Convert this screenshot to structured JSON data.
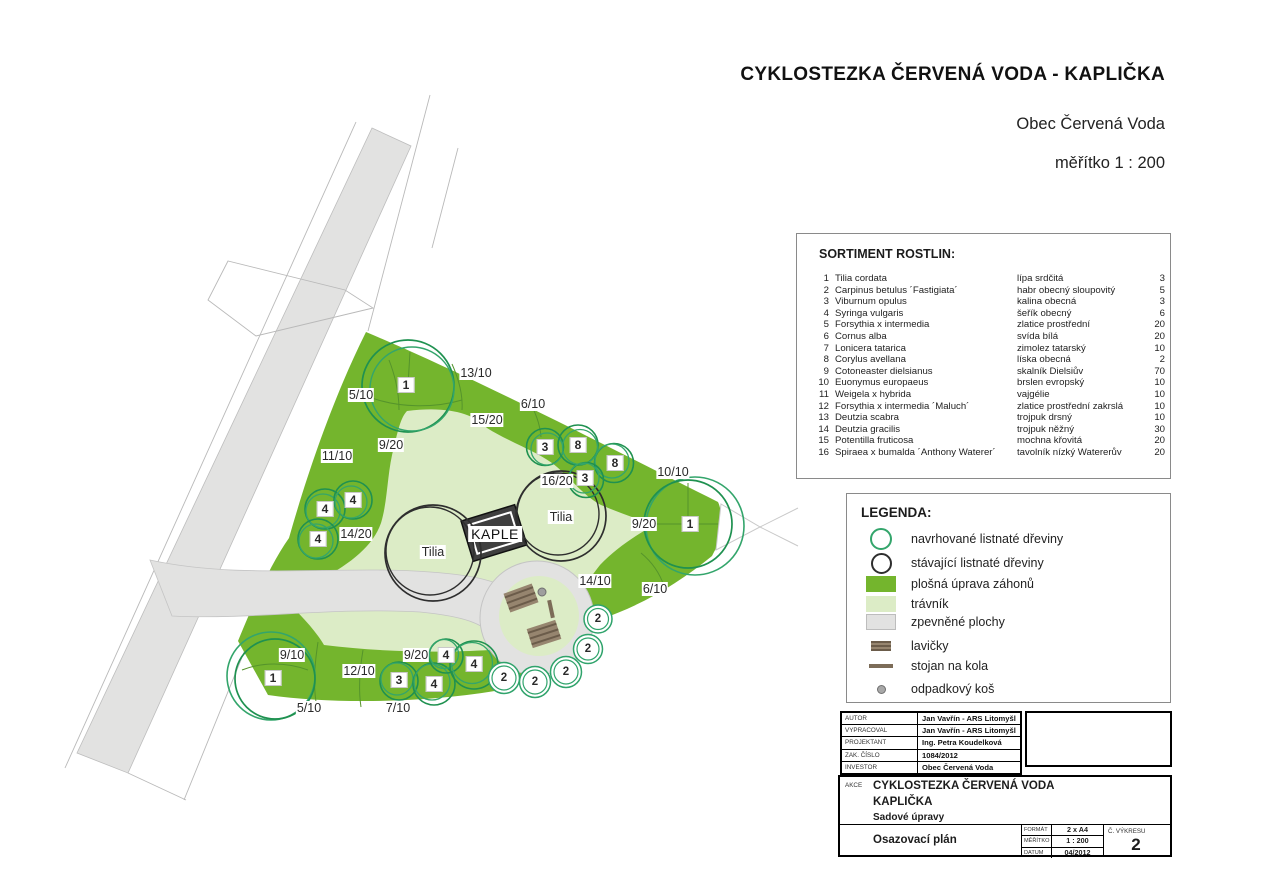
{
  "header": {
    "title": "CYKLOSTEZKA ČERVENÁ VODA - KAPLIČKA",
    "subtitle": "Obec Červená Voda",
    "scale_note": "měřítko 1 : 200"
  },
  "colors": {
    "bed_green": "#74b52d",
    "lawn_green": "#dcecc6",
    "paving_gray": "#e2e2e1",
    "proposed_tree_outline": "#33a56b",
    "existing_tree_outline": "#2e2e2e",
    "bench_brown": "#8b7b67"
  },
  "sortiment": {
    "title": "SORTIMENT ROSTLIN:",
    "rows": [
      {
        "num": "1",
        "latin": "Tilia cordata",
        "czech": "lípa srdčitá",
        "count": "3"
      },
      {
        "num": "2",
        "latin": "Carpinus betulus ´Fastigiata´",
        "czech": "habr obecný sloupovitý",
        "count": "5"
      },
      {
        "num": "3",
        "latin": "Viburnum opulus",
        "czech": "kalina obecná",
        "count": "3"
      },
      {
        "num": "4",
        "latin": "Syringa vulgaris",
        "czech": "šeřík obecný",
        "count": "6"
      },
      {
        "num": "5",
        "latin": "Forsythia x intermedia",
        "czech": "zlatice prostřední",
        "count": "20"
      },
      {
        "num": "6",
        "latin": "Cornus alba",
        "czech": "svída bílá",
        "count": "20"
      },
      {
        "num": "7",
        "latin": "Lonicera tatarica",
        "czech": "zimolez tatarský",
        "count": "10"
      },
      {
        "num": "8",
        "latin": "Corylus avellana",
        "czech": "líska obecná",
        "count": "2"
      },
      {
        "num": "9",
        "latin": "Cotoneaster dielsianus",
        "czech": "skalník Dielsiův",
        "count": "70"
      },
      {
        "num": "10",
        "latin": "Euonymus europaeus",
        "czech": "brslen evropský",
        "count": "10"
      },
      {
        "num": "11",
        "latin": "Weigela x hybrida",
        "czech": "vajgélie",
        "count": "10"
      },
      {
        "num": "12",
        "latin": "Forsythia x intermedia ´Maluch´",
        "czech": "zlatice prostřední zakrslá",
        "count": "10"
      },
      {
        "num": "13",
        "latin": "Deutzia scabra",
        "czech": "trojpuk drsný",
        "count": "10"
      },
      {
        "num": "14",
        "latin": "Deutzia gracilis",
        "czech": "trojpuk něžný",
        "count": "30"
      },
      {
        "num": "15",
        "latin": "Potentilla fruticosa",
        "czech": "mochna křovitá",
        "count": "20"
      },
      {
        "num": "16",
        "latin": "Spiraea x bumalda ´Anthony Waterer´",
        "czech": "tavolník nízký Watererův",
        "count": "20"
      }
    ]
  },
  "legend": {
    "title": "LEGENDA:",
    "items": [
      {
        "symbol": "proposed-tree-circle",
        "label": "navrhované listnaté dřeviny"
      },
      {
        "symbol": "existing-tree-circle",
        "label": "stávající listnaté dřeviny"
      },
      {
        "symbol": "bed-swatch",
        "label": "plošná úprava záhonů"
      },
      {
        "symbol": "lawn-swatch",
        "label": "trávník"
      },
      {
        "symbol": "paving-swatch",
        "label": "zpevněné plochy"
      },
      {
        "symbol": "bench",
        "label": "lavičky"
      },
      {
        "symbol": "bike-stand",
        "label": "stojan na kola"
      },
      {
        "symbol": "trash-bin",
        "label": "odpadkový koš"
      }
    ]
  },
  "info_table": {
    "rows": [
      {
        "label": "AUTOR",
        "value": "Jan Vavřín - ARS Litomyšl"
      },
      {
        "label": "VYPRACOVAL",
        "value": "Jan Vavřín - ARS Litomyšl"
      },
      {
        "label": "PROJEKTANT",
        "value": "Ing. Petra Koudelková"
      },
      {
        "label": "ZAK. ČÍSLO",
        "value": "1084/2012"
      },
      {
        "label": "INVESTOR",
        "value": "Obec Červená Voda"
      }
    ]
  },
  "title_block": {
    "akce_label": "AKCE",
    "project_line1": "CYKLOSTEZKA ČERVENÁ VODA",
    "project_line2": "KAPLIČKA",
    "project_line3": "Sadové  úpravy",
    "drawing_name": "Osazovací plán",
    "fields": [
      {
        "label": "FORMÁT",
        "value": "2 x A4"
      },
      {
        "label": "MĚŘÍTKO",
        "value": "1 : 200"
      },
      {
        "label": "DATUM",
        "value": "04/2012"
      }
    ],
    "drawing_no_label": "Č. VÝKRESU",
    "drawing_no": "2"
  },
  "plan": {
    "labels": {
      "fractions": [
        {
          "t": "13/10",
          "x": 476,
          "y": 373
        },
        {
          "t": "5/10",
          "x": 361,
          "y": 395
        },
        {
          "t": "6/10",
          "x": 533,
          "y": 404
        },
        {
          "t": "15/20",
          "x": 487,
          "y": 420
        },
        {
          "t": "9/20",
          "x": 391,
          "y": 445
        },
        {
          "t": "11/10",
          "x": 337,
          "y": 456
        },
        {
          "t": "16/20",
          "x": 557,
          "y": 481
        },
        {
          "t": "10/10",
          "x": 673,
          "y": 472
        },
        {
          "t": "9/20",
          "x": 644,
          "y": 524
        },
        {
          "t": "14/20",
          "x": 356,
          "y": 534
        },
        {
          "t": "14/10",
          "x": 595,
          "y": 581
        },
        {
          "t": "6/10",
          "x": 655,
          "y": 589
        },
        {
          "t": "9/10",
          "x": 292,
          "y": 655
        },
        {
          "t": "9/20",
          "x": 416,
          "y": 655
        },
        {
          "t": "12/10",
          "x": 359,
          "y": 671
        },
        {
          "t": "5/10",
          "x": 309,
          "y": 708
        },
        {
          "t": "7/10",
          "x": 398,
          "y": 708
        }
      ],
      "refs": [
        {
          "t": "1",
          "x": 406,
          "y": 385
        },
        {
          "t": "3",
          "x": 545,
          "y": 447
        },
        {
          "t": "8",
          "x": 578,
          "y": 445
        },
        {
          "t": "8",
          "x": 615,
          "y": 463
        },
        {
          "t": "3",
          "x": 585,
          "y": 478
        },
        {
          "t": "4",
          "x": 353,
          "y": 500
        },
        {
          "t": "4",
          "x": 325,
          "y": 509
        },
        {
          "t": "4",
          "x": 318,
          "y": 539
        },
        {
          "t": "1",
          "x": 690,
          "y": 524
        },
        {
          "t": "1",
          "x": 273,
          "y": 678
        },
        {
          "t": "3",
          "x": 399,
          "y": 680
        },
        {
          "t": "4",
          "x": 434,
          "y": 684
        },
        {
          "t": "4",
          "x": 446,
          "y": 655
        },
        {
          "t": "4",
          "x": 474,
          "y": 664
        }
      ],
      "tree_refs": [
        {
          "t": "2",
          "x": 504,
          "y": 678
        },
        {
          "t": "2",
          "x": 535,
          "y": 682
        },
        {
          "t": "2",
          "x": 566,
          "y": 672
        },
        {
          "t": "2",
          "x": 588,
          "y": 649
        },
        {
          "t": "2",
          "x": 598,
          "y": 619
        }
      ],
      "names": [
        {
          "t": "Tilia",
          "x": 433,
          "y": 552
        },
        {
          "t": "Tilia",
          "x": 561,
          "y": 517
        }
      ],
      "building": {
        "t": "KAPLE",
        "x": 495,
        "y": 534
      }
    }
  }
}
